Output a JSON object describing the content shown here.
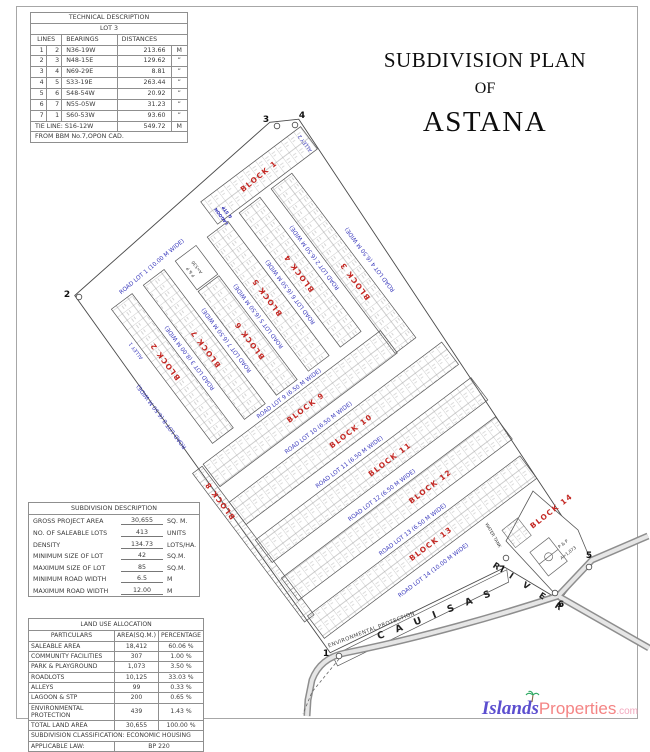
{
  "title": {
    "line1": "SUBDIVISION PLAN",
    "line2": "OF",
    "line3": "ASTANA"
  },
  "technical_description": {
    "title": "TECHNICAL DESCRIPTION",
    "subtitle": "LOT 3",
    "col_lines": "LINES",
    "col_bearings": "BEARINGS",
    "col_distances": "DISTANCES",
    "rows": [
      {
        "from": "1",
        "to": "2",
        "bearing": "N36-19W",
        "distance": "213.66",
        "unit": "M"
      },
      {
        "from": "2",
        "to": "3",
        "bearing": "N48-15E",
        "distance": "129.62",
        "unit": "”"
      },
      {
        "from": "3",
        "to": "4",
        "bearing": "N69-29E",
        "distance": "8.81",
        "unit": "”"
      },
      {
        "from": "4",
        "to": "5",
        "bearing": "S33-19E",
        "distance": "263.44",
        "unit": "”"
      },
      {
        "from": "5",
        "to": "6",
        "bearing": "S48-54W",
        "distance": "20.92",
        "unit": "”"
      },
      {
        "from": "6",
        "to": "7",
        "bearing": "N55-05W",
        "distance": "31.23",
        "unit": "”"
      },
      {
        "from": "7",
        "to": "1",
        "bearing": "S60-53W",
        "distance": "93.60",
        "unit": "”"
      }
    ],
    "tie_label": "TIE LINE:",
    "tie_bearing": "S16-12W",
    "tie_distance": "549.72",
    "tie_unit": "M",
    "footnote": "FROM BBM No.7,OPON CAD."
  },
  "subdivision_description": {
    "title": "SUBDIVISION DESCRIPTION",
    "rows": [
      {
        "label": "GROSS PROJECT AREA",
        "value": "30,655",
        "unit": "SQ. M."
      },
      {
        "label": "NO. OF SALEABLE LOTS",
        "value": "413",
        "unit": "UNITS"
      },
      {
        "label": "DENSITY",
        "value": "134.73",
        "unit": "LOTS/HA."
      },
      {
        "label": "MINIMUM SIZE OF LOT",
        "value": "42",
        "unit": "SQ.M."
      },
      {
        "label": "MAXIMUM SIZE OF LOT",
        "value": "85",
        "unit": "SQ.M."
      },
      {
        "label": "MINIMUM ROAD WIDTH",
        "value": "6.5",
        "unit": "M"
      },
      {
        "label": "MAXIMUM ROAD WIDTH",
        "value": "12.00",
        "unit": "M"
      }
    ]
  },
  "land_use_allocation": {
    "title": "LAND USE ALLOCATION",
    "col_particulars": "PARTICULARS",
    "col_area": "AREA(SQ.M.)",
    "col_pct": "PERCENTAGE",
    "rows": [
      {
        "label": "SALEABLE AREA",
        "area": "18,412",
        "pct": "60.06 %"
      },
      {
        "label": "COMMUNITY FACILITIES",
        "area": "307",
        "pct": "1.00 %"
      },
      {
        "label": "PARK & PLAYGROUND",
        "area": "1,073",
        "pct": "3.50 %"
      },
      {
        "label": "ROADLOTS",
        "area": "10,125",
        "pct": "33.03 %"
      },
      {
        "label": "ALLEYS",
        "area": "99",
        "pct": "0.33 %"
      },
      {
        "label": "LAGOON & STP",
        "area": "200",
        "pct": "0.65 %"
      },
      {
        "label": "ENVIRONMENTAL PROTECTION",
        "area": "439",
        "pct": "1.43 %"
      },
      {
        "label": "TOTAL LAND AREA",
        "area": "30,655",
        "pct": "100.00 %"
      }
    ],
    "classification_label": "SUBDIVISION CLASSIFICATION:",
    "classification_value": "ECONOMIC HOUSING",
    "law_label": "APPLICABLE LAW:",
    "law_value": "BP 220"
  },
  "map": {
    "labels": {
      "road1": "ROAD LOT 1 (10.00 M WIDE)",
      "road2": "ROAD LOT 2 (6.50 M WIDE)",
      "road3": "ROAD LOT 3 (8.00 M WIDE)",
      "road4": "ROAD LOT 4 (6.50 M WIDE)",
      "road5": "ROAD LOT 5 (6.50 M WIDE)",
      "road6": "ROAD LOT 6 (6.50 M WIDE)",
      "road7": "ROAD LOT 7 (6.50 M WIDE)",
      "road8": "ROAD LOT 8 (6.50 M WIDE)",
      "road9": "ROAD LOT 9 (6.50 M WIDE)",
      "road10": "ROAD LOT 10 (6.50 M WIDE)",
      "road11": "ROAD LOT 11 (6.50 M WIDE)",
      "road12": "ROAD LOT 12 (6.50 M WIDE)",
      "road13": "ROAD LOT 13 (6.50 M WIDE)",
      "road14": "ROAD LOT 14 (10.00 M WIDE)",
      "alley1": "ALLEY 1",
      "alley2": "ALLEY 2",
      "block1": "BLOCK 1",
      "block2": "BLOCK 2",
      "block3": "BLOCK 3",
      "block4": "BLOCK 4",
      "block5": "BLOCK 5",
      "block6": "BLOCK 6",
      "block7": "BLOCK 7",
      "block8": "BLOCK 8",
      "block9": "BLOCK 9",
      "block10": "BLOCK 10",
      "block11": "BLOCK 11",
      "block12": "BLOCK 12",
      "block13": "BLOCK 13",
      "block14": "BLOCK 14",
      "river": "R I V E R",
      "road_name": "C A U I S A S",
      "environmental": "ENVIRONMENTAL PROTECTION",
      "water_tank": "WATER TANK",
      "park1": "P & P",
      "park1_area": "A=1,073",
      "park2": "P & P",
      "park2_area": "A=530",
      "lagoon_line1": "LAGOON",
      "lagoon_line2": "& STP"
    },
    "points": {
      "p1": "1",
      "p2": "2",
      "p3": "3",
      "p4": "4",
      "p5": "5",
      "p6": "6",
      "p7": "7"
    }
  },
  "logo": {
    "islands": "Islands",
    "properties": "Properties",
    "tld": ".com"
  }
}
